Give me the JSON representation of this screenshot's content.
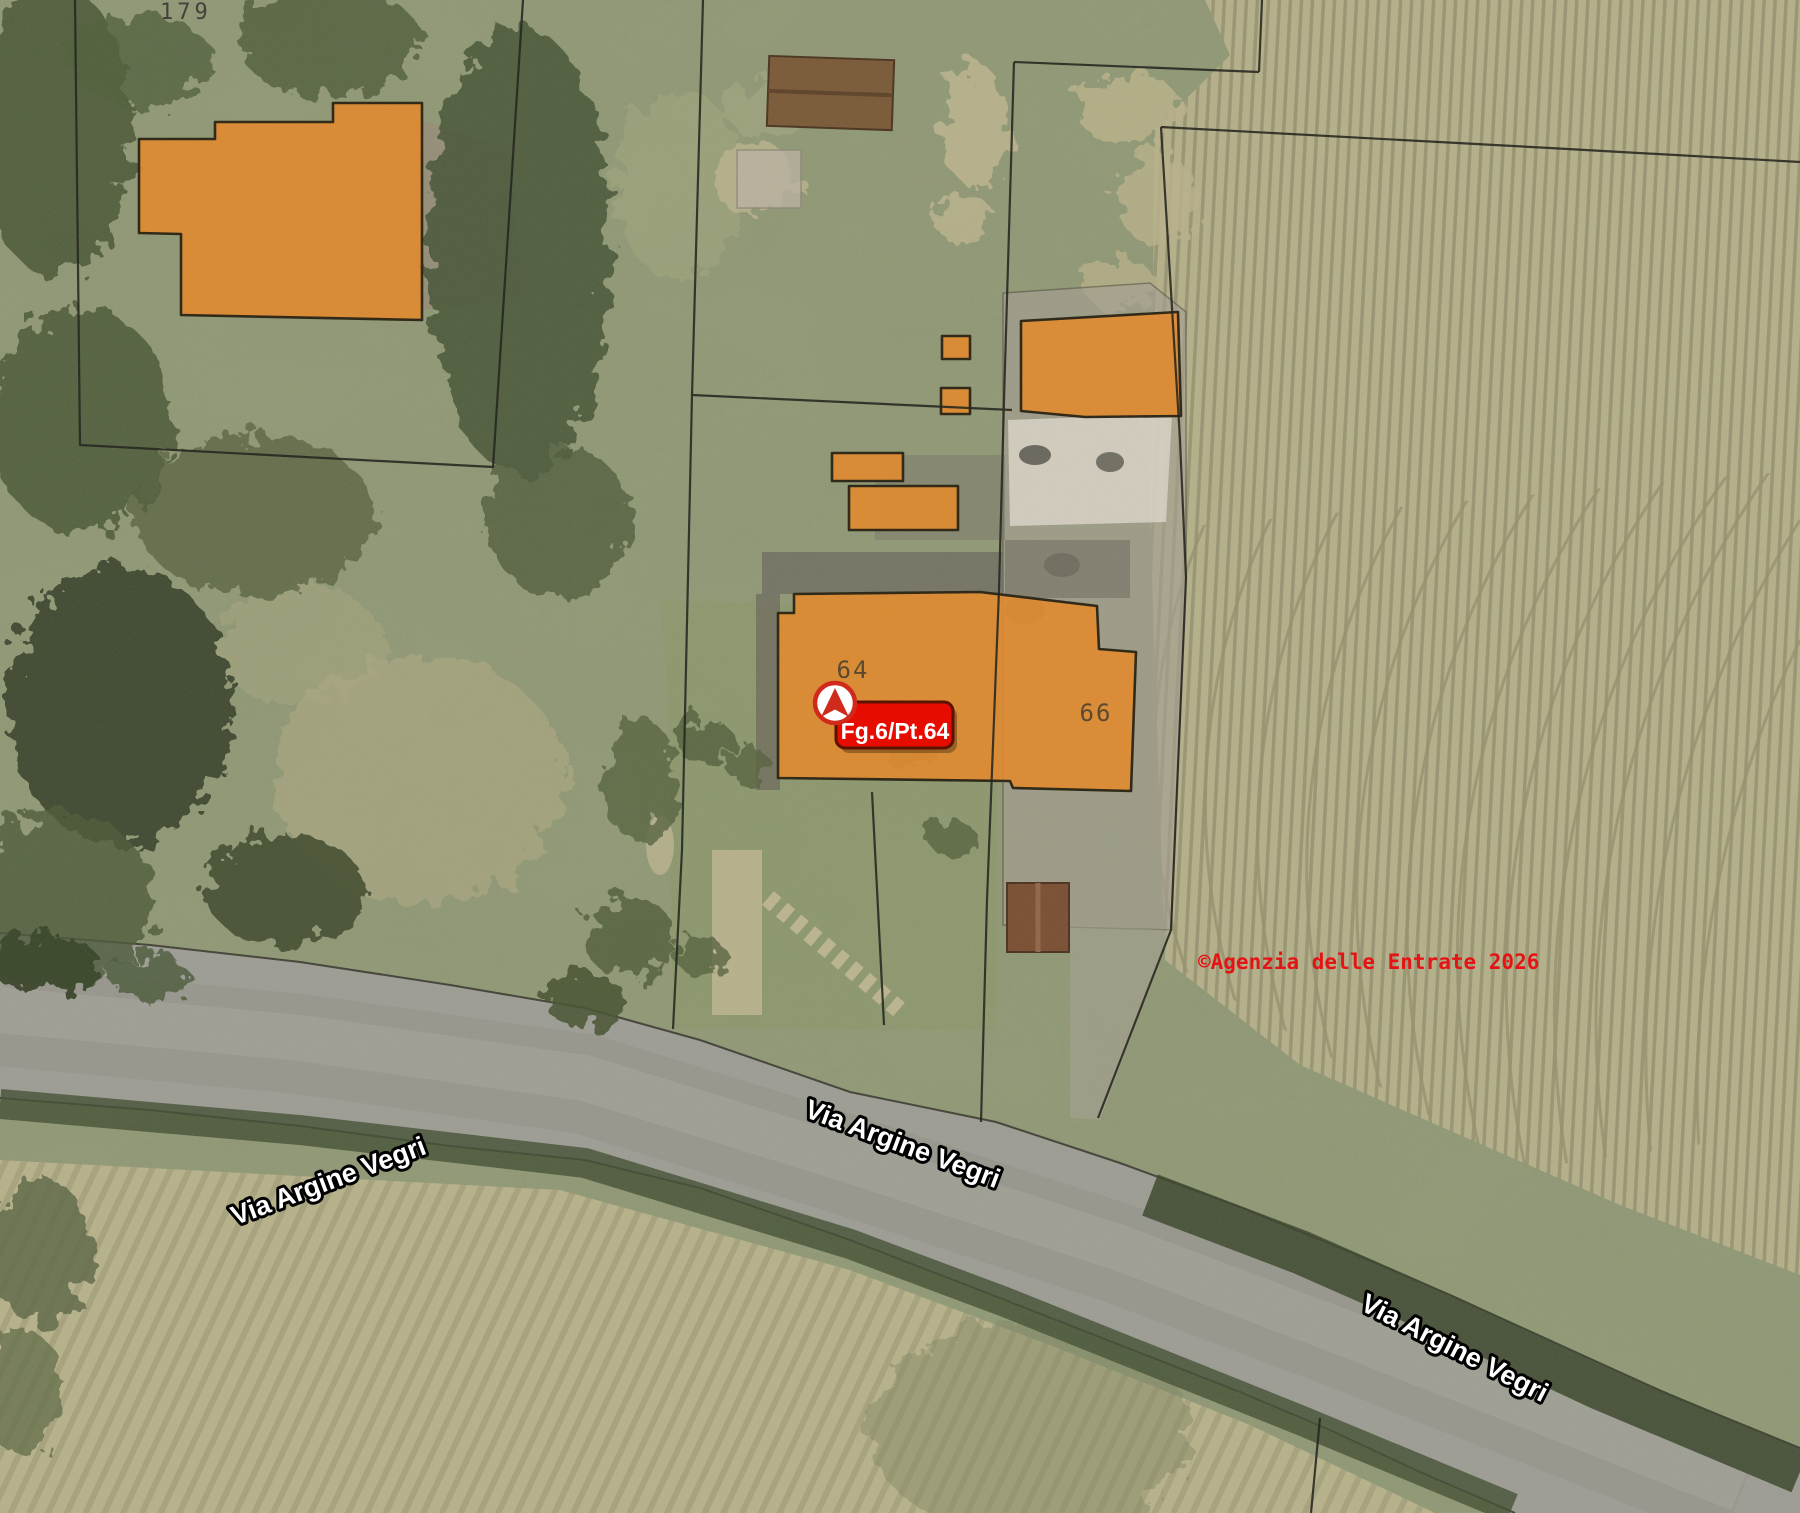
{
  "map": {
    "parcel_labels": {
      "p179": "179",
      "p64": "64",
      "p66": "66"
    },
    "marker_badge": {
      "text": "Fg.6/Pt.64"
    },
    "street_labels": {
      "west": "Via Argine Vegri",
      "center": "Via Argine Vegri",
      "east": "Via Argine Vegri"
    },
    "copyright_notice": "©Agenzia delle Entrate 2026"
  },
  "colors": {
    "parcel_highlight": "#e1892c",
    "parcel_highlight_outline": "#2b2413",
    "boundary_line": "#20201a",
    "badge_fill": "#e60d00",
    "badge_border": "#5d1200",
    "badge_text": "#ffffff",
    "copyright": "#e41414",
    "street_label_fill": "#ffffff",
    "street_label_outline": "#000000",
    "map_label": "#4a4434"
  }
}
